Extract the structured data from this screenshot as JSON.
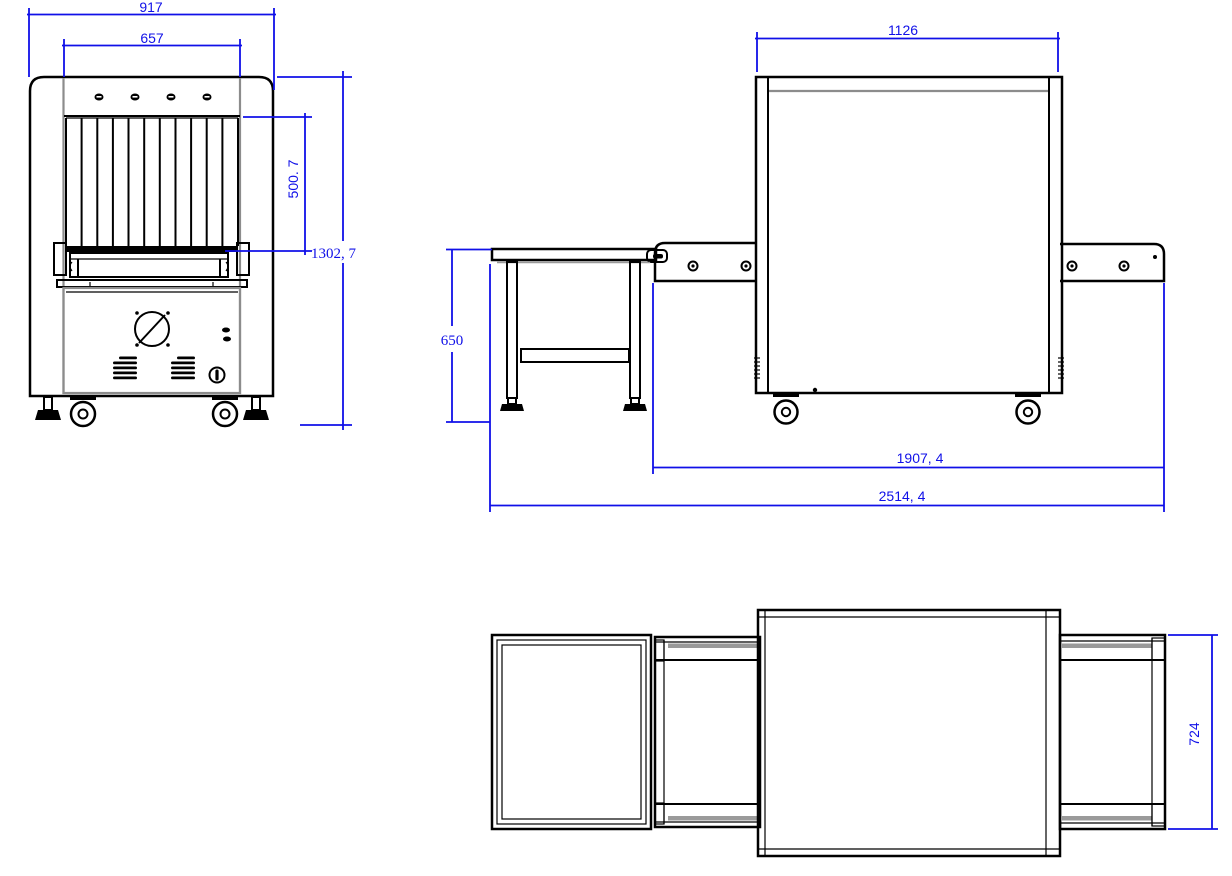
{
  "drawing_type": "technical-dimension-drawing",
  "colors": {
    "dimension_blue": "#1010e8",
    "outline_black": "#000000",
    "detail_gray": "#8c8c8c"
  },
  "views": {
    "front": {
      "name": "front-elevation",
      "dims": {
        "overall_width": "917",
        "tunnel_width": "657",
        "tunnel_height": "500. 7",
        "overall_height": "1302, 7"
      }
    },
    "side": {
      "name": "side-elevation",
      "dims": {
        "body_length": "1126",
        "table_height": "650",
        "machine_length": "1907, 4",
        "overall_length": "2514, 4"
      }
    },
    "top": {
      "name": "plan-view",
      "dims": {
        "extension_width": "724"
      }
    }
  }
}
